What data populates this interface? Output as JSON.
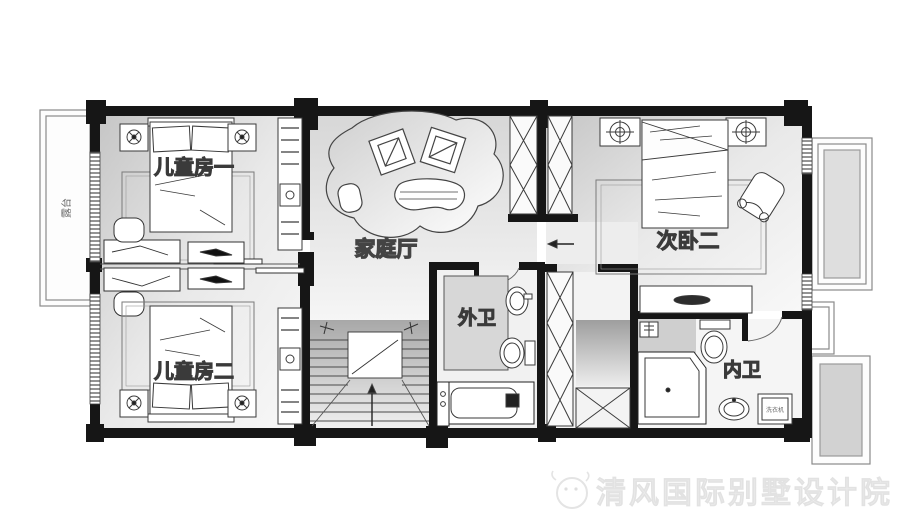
{
  "plan": {
    "rooms": {
      "kids1": {
        "label": "儿童房一"
      },
      "kids2": {
        "label": "儿童房二"
      },
      "family": {
        "label": "家庭厅"
      },
      "bedroom2": {
        "label": "次卧二"
      },
      "outer_bath": {
        "label": "外卫"
      },
      "inner_bath": {
        "label": "内卫"
      },
      "balcony_left": {
        "label": "露台"
      }
    },
    "fixtures": {
      "washer_label": "洗衣机"
    }
  },
  "watermark": {
    "text": "清风国际别墅设计院"
  },
  "colors": {
    "wall": "#161616",
    "furniture_line": "#3a3a3a",
    "room_shade": "#c9c9c9",
    "watermark": "#ededed"
  }
}
